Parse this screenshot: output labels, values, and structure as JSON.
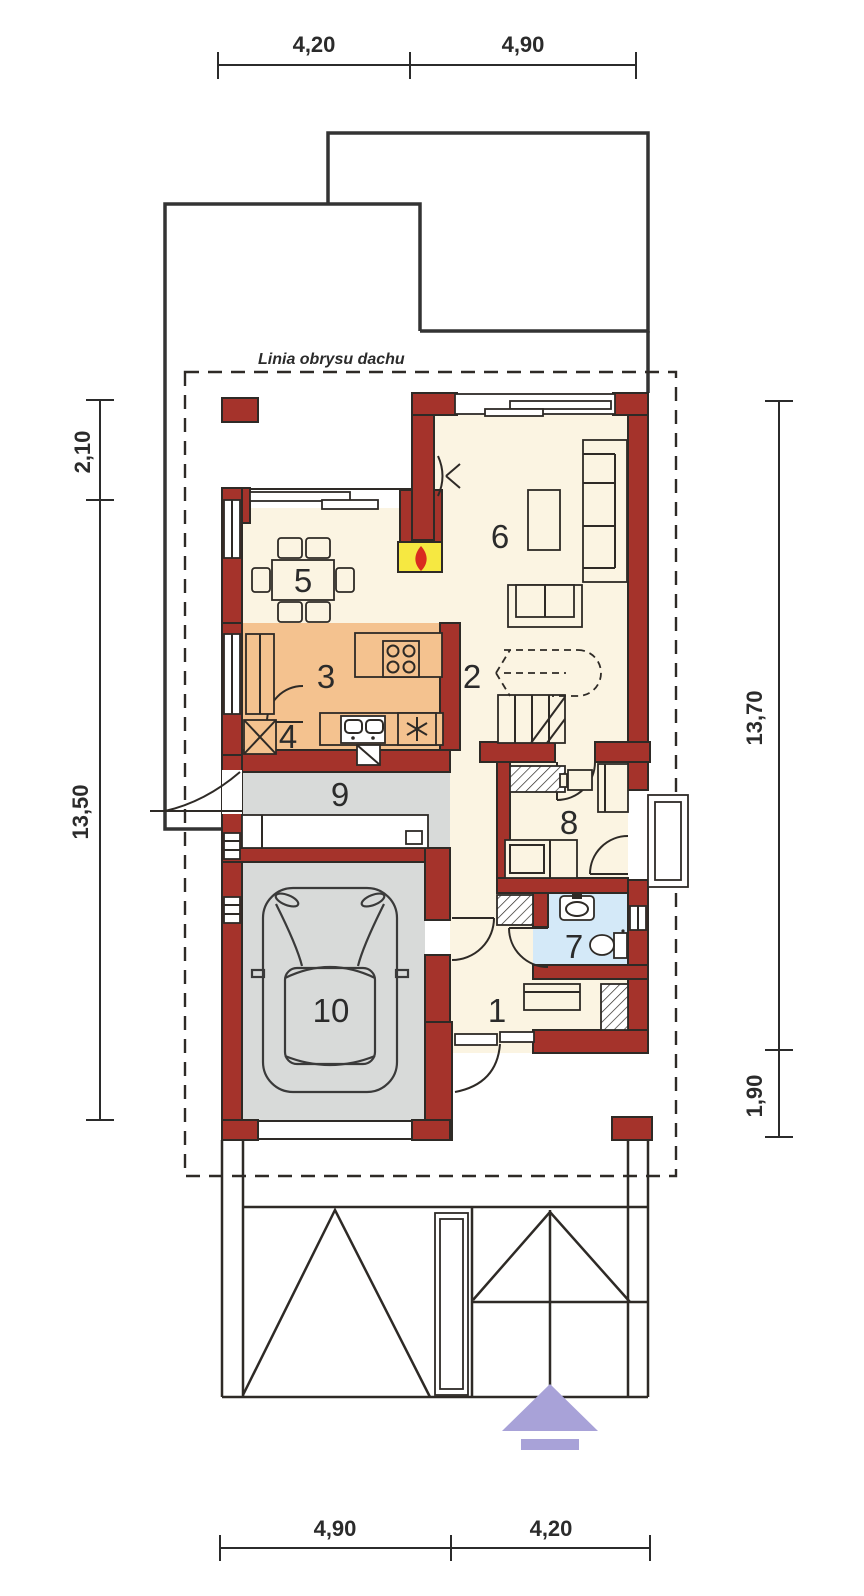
{
  "roof_outline_label": "Linia obrysu dachu",
  "dimensions": {
    "top": [
      "4,20",
      "4,90"
    ],
    "bottom": [
      "4,90",
      "4,20"
    ],
    "left": [
      "2,10",
      "13,50"
    ],
    "right": [
      "13,70",
      "1,90"
    ]
  },
  "rooms": [
    {
      "number": "1"
    },
    {
      "number": "2"
    },
    {
      "number": "3"
    },
    {
      "number": "4"
    },
    {
      "number": "5"
    },
    {
      "number": "6"
    },
    {
      "number": "7"
    },
    {
      "number": "8"
    },
    {
      "number": "9"
    },
    {
      "number": "10"
    }
  ],
  "colors": {
    "wall": "#A5332B",
    "floor_main": "#FBF4E2",
    "floor_kitchen": "#F4C28F",
    "floor_utility": "#D8DAD9",
    "floor_garage": "#D8DAD9",
    "floor_bath": "#D4E9F8",
    "fireplace": "#F6E841",
    "flame": "#D92B1F",
    "arrow": "#A8A2D8",
    "line": "#2E2A26"
  }
}
